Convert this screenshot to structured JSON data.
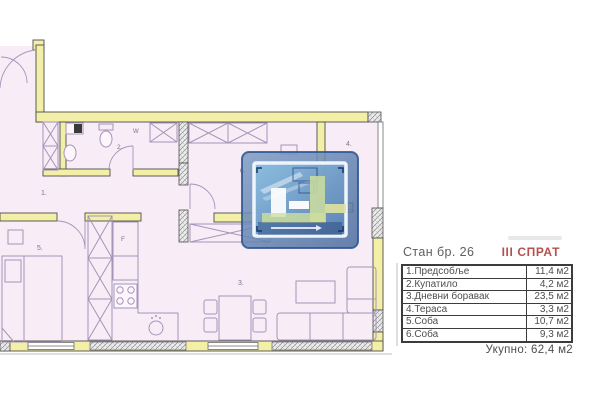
{
  "panel": {
    "apartment_label": "Стан бр. 26",
    "floor_label": "III СПРАТ",
    "rows": [
      {
        "name": "1.Предсобље",
        "area": "11,4 м2"
      },
      {
        "name": "2.Купатило",
        "area": "4,2 м2"
      },
      {
        "name": "3.Дневни боравак",
        "area": "23,5 м2"
      },
      {
        "name": "4.Тераса",
        "area": "3,3 м2"
      },
      {
        "name": "5.Соба",
        "area": "10,7 м2"
      },
      {
        "name": "6.Соба",
        "area": "9,3 м2"
      }
    ],
    "total_label": "Укупно: 62,4 м2"
  },
  "plan": {
    "room_numbers": {
      "hall": "1.",
      "bath": "2.",
      "living": "3.",
      "terrace": "4.",
      "bedroom5": "5.",
      "bedroom6": "6."
    },
    "fixture_labels": {
      "washer": "W",
      "fridge": "F"
    }
  },
  "colors": {
    "floor_fill": "#f8ecf7",
    "wall_fill": "#f4efa7",
    "accent_red": "#b4504e",
    "overlay_blue": "#5f7fae",
    "table_border": "#3c3c3c"
  }
}
